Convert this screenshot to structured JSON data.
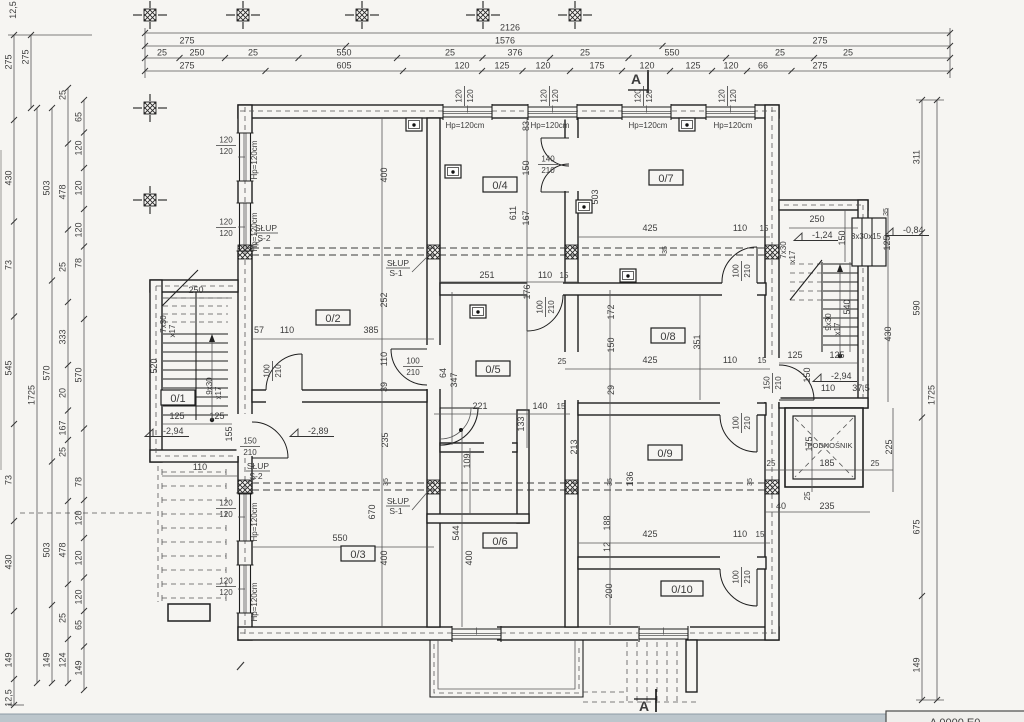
{
  "meta": {
    "paper_color": "#f6f5f2",
    "ink_color": "#1f1f1f",
    "dim_text_color": "#3c3c3c",
    "scanner_strip_color": "#bcc6cc"
  },
  "title_block": {
    "text": "A 0000 E0"
  },
  "section_markers": [
    [
      "A",
      636,
      84
    ],
    [
      "A",
      644,
      711
    ]
  ],
  "grid_crosses": [
    [
      150,
      15
    ],
    [
      243,
      15
    ],
    [
      362,
      15
    ],
    [
      483,
      15
    ],
    [
      575,
      15
    ],
    [
      150,
      108
    ],
    [
      150,
      200
    ]
  ],
  "fixtures": [
    [
      414,
      125
    ],
    [
      687,
      125
    ],
    [
      453,
      172
    ],
    [
      584,
      207
    ],
    [
      628,
      276
    ],
    [
      478,
      312
    ]
  ],
  "room_labels": [
    [
      "0/1",
      178,
      400
    ],
    [
      "0/2",
      333,
      320
    ],
    [
      "0/3",
      358,
      556
    ],
    [
      "0/4",
      500,
      187
    ],
    [
      "0/5",
      493,
      371
    ],
    [
      "0/6",
      500,
      543
    ],
    [
      "0/7",
      666,
      180
    ],
    [
      "0/8",
      668,
      338
    ],
    [
      "0/9",
      665,
      455
    ],
    [
      "0/10",
      682,
      591
    ]
  ],
  "dim_rows": [
    {
      "y": 33,
      "x1": 145,
      "x2": 950,
      "labels": [
        [
          "2126",
          510
        ]
      ]
    },
    {
      "y": 46,
      "x1": 145,
      "x2": 950,
      "labels": [
        [
          "275",
          187
        ],
        [
          "1576",
          505
        ],
        [
          "275",
          820
        ]
      ]
    },
    {
      "y": 58,
      "x1": 145,
      "x2": 950,
      "labels": [
        [
          "25",
          162
        ],
        [
          "250",
          197
        ],
        [
          "25",
          253
        ],
        [
          "550",
          344
        ],
        [
          "25",
          450
        ],
        [
          "376",
          515
        ],
        [
          "25",
          585
        ],
        [
          "550",
          672
        ],
        [
          "25",
          780
        ],
        [
          "25",
          848
        ]
      ]
    },
    {
      "y": 71,
      "x1": 145,
      "x2": 950,
      "labels": [
        [
          "275",
          187
        ],
        [
          "605",
          344
        ],
        [
          "120",
          462
        ],
        [
          "125",
          502
        ],
        [
          "120",
          543
        ],
        [
          "175",
          597
        ],
        [
          "120",
          647
        ],
        [
          "125",
          693
        ],
        [
          "120",
          731
        ],
        [
          "66",
          763
        ],
        [
          "275",
          820
        ]
      ]
    }
  ],
  "dim_cols": [
    {
      "x": 14,
      "y1": 35,
      "y2": 705,
      "labels": [
        [
          "275",
          62
        ],
        [
          "430",
          178
        ],
        [
          "73",
          265
        ],
        [
          "545",
          368
        ],
        [
          "73",
          480
        ],
        [
          "430",
          562
        ],
        [
          "149",
          660
        ],
        [
          "12,5",
          698
        ]
      ]
    },
    {
      "x": 31,
      "y1": 35,
      "y2": 108,
      "labels": [
        [
          "275",
          57
        ]
      ]
    },
    {
      "x": 37,
      "y1": 108,
      "y2": 683,
      "labels": [
        [
          "1725",
          395
        ]
      ]
    },
    {
      "x": 52,
      "y1": 108,
      "y2": 683,
      "labels": [
        [
          "503",
          188
        ],
        [
          "570",
          373
        ],
        [
          "503",
          550
        ],
        [
          "149",
          660
        ]
      ]
    },
    {
      "x": 68,
      "y1": 88,
      "y2": 683,
      "labels": [
        [
          "25",
          95
        ],
        [
          "478",
          192
        ],
        [
          "25",
          267
        ],
        [
          "333",
          337
        ],
        [
          "20",
          393
        ],
        [
          "167",
          428
        ],
        [
          "25",
          452
        ],
        [
          "478",
          550
        ],
        [
          "25",
          618
        ],
        [
          "124",
          660
        ]
      ]
    },
    {
      "x": 84,
      "y1": 100,
      "y2": 690,
      "labels": [
        [
          "65",
          117
        ],
        [
          "120",
          148
        ],
        [
          "120",
          188
        ],
        [
          "120",
          230
        ],
        [
          "78",
          263
        ],
        [
          "570",
          375
        ],
        [
          "78",
          482
        ],
        [
          "120",
          518
        ],
        [
          "120",
          558
        ],
        [
          "120",
          597
        ],
        [
          "65",
          625
        ],
        [
          "149",
          668
        ]
      ]
    },
    {
      "x": 922,
      "y1": 100,
      "y2": 700,
      "labels": [
        [
          "311",
          157
        ],
        [
          "590",
          308
        ],
        [
          "675",
          527
        ],
        [
          "149",
          665
        ]
      ]
    },
    {
      "x": 937,
      "y1": 100,
      "y2": 700,
      "labels": [
        [
          "1725",
          395
        ]
      ]
    }
  ],
  "texts": [
    [
      "400",
      387,
      175,
      -90,
      9
    ],
    [
      "252",
      387,
      300,
      -90,
      9
    ],
    [
      "110",
      387,
      359,
      -90,
      9
    ],
    [
      "39",
      387,
      387,
      -90,
      9
    ],
    [
      "235",
      388,
      440,
      -90,
      9
    ],
    [
      "57",
      259,
      333,
      0,
      9
    ],
    [
      "110",
      287,
      333,
      0,
      9
    ],
    [
      "385",
      371,
      333,
      0,
      9
    ],
    [
      "550",
      340,
      541,
      0,
      9
    ],
    [
      "670",
      375,
      512,
      -90,
      9
    ],
    [
      "400",
      387,
      558,
      -90,
      9
    ],
    [
      "251",
      487,
      278,
      0,
      9
    ],
    [
      "110",
      545,
      278,
      0,
      9
    ],
    [
      "15",
      564,
      278,
      0,
      8
    ],
    [
      "611",
      516,
      213,
      -90,
      9
    ],
    [
      "176",
      530,
      292,
      -90,
      9
    ],
    [
      "83",
      529,
      126,
      -90,
      9
    ],
    [
      "150",
      529,
      168,
      -90,
      9
    ],
    [
      "167",
      529,
      218,
      -90,
      9
    ],
    [
      "503",
      598,
      197,
      -90,
      9
    ],
    [
      "425",
      650,
      231,
      0,
      9
    ],
    [
      "110",
      740,
      231,
      0,
      9
    ],
    [
      "15",
      764,
      231,
      0,
      8
    ],
    [
      "25",
      562,
      364,
      0,
      8
    ],
    [
      "425",
      650,
      363,
      0,
      9
    ],
    [
      "110",
      730,
      363,
      0,
      9
    ],
    [
      "15",
      762,
      363,
      0,
      8
    ],
    [
      "172",
      614,
      312,
      -90,
      9
    ],
    [
      "351",
      700,
      342,
      -90,
      9
    ],
    [
      "150",
      614,
      345,
      -90,
      9
    ],
    [
      "29",
      614,
      390,
      -90,
      9
    ],
    [
      "221",
      480,
      409,
      0,
      9
    ],
    [
      "140",
      540,
      409,
      0,
      9
    ],
    [
      "15",
      561,
      409,
      0,
      8
    ],
    [
      "347",
      457,
      380,
      -90,
      9
    ],
    [
      "64",
      446,
      373,
      -90,
      9
    ],
    [
      "133",
      524,
      424,
      -90,
      9
    ],
    [
      "109",
      470,
      461,
      -90,
      9
    ],
    [
      "425",
      650,
      537,
      0,
      9
    ],
    [
      "110",
      740,
      537,
      0,
      9
    ],
    [
      "15",
      760,
      537,
      0,
      8
    ],
    [
      "213",
      577,
      447,
      -90,
      9
    ],
    [
      "136",
      633,
      479,
      -90,
      9
    ],
    [
      "188",
      610,
      523,
      -90,
      9
    ],
    [
      "12",
      610,
      547,
      -90,
      9
    ],
    [
      "200",
      612,
      591,
      -90,
      9
    ],
    [
      "544",
      459,
      533,
      -90,
      9
    ],
    [
      "400",
      472,
      558,
      -90,
      9
    ],
    [
      "35",
      388,
      482,
      -90,
      7
    ],
    [
      "35",
      612,
      482,
      -90,
      7
    ],
    [
      "35",
      752,
      482,
      -90,
      7
    ],
    [
      "35",
      667,
      250,
      -90,
      7
    ],
    [
      "110",
      200,
      470,
      0,
      9
    ],
    [
      "250",
      196,
      293,
      0,
      9
    ],
    [
      "520",
      157,
      366,
      -90,
      9
    ],
    [
      "125",
      177,
      419,
      0,
      9
    ],
    [
      "125",
      217,
      419,
      0,
      9
    ],
    [
      "155",
      232,
      434,
      -90,
      9
    ],
    [
      "7x30",
      166,
      324,
      -90,
      8
    ],
    [
      "x17",
      175,
      331,
      -90,
      8
    ],
    [
      "9x30",
      212,
      386,
      -90,
      8
    ],
    [
      "x17",
      221,
      393,
      -90,
      8
    ],
    [
      "250",
      817,
      222,
      0,
      9
    ],
    [
      "150",
      845,
      238,
      -90,
      9
    ],
    [
      "35",
      888,
      212,
      -90,
      7
    ],
    [
      "125",
      890,
      243,
      -90,
      9
    ],
    [
      "540",
      850,
      307,
      -90,
      9
    ],
    [
      "430",
      891,
      334,
      -90,
      9
    ],
    [
      "125",
      795,
      358,
      0,
      9
    ],
    [
      "125",
      837,
      358,
      0,
      9
    ],
    [
      "150",
      810,
      375,
      -90,
      9
    ],
    [
      "110",
      828,
      391,
      0,
      9
    ],
    [
      "37,5",
      861,
      391,
      0,
      9
    ],
    [
      "7x30",
      786,
      250,
      -90,
      8
    ],
    [
      "x17",
      795,
      257,
      -90,
      8
    ],
    [
      "9x30",
      831,
      322,
      -90,
      8
    ],
    [
      "x17",
      840,
      329,
      -90,
      8
    ],
    [
      "3x30x15",
      866,
      239,
      0,
      8
    ],
    [
      "PODNOŚNIK",
      830,
      448,
      0,
      7.5
    ],
    [
      "185",
      827,
      466,
      0,
      9
    ],
    [
      "25",
      771,
      466,
      0,
      8
    ],
    [
      "25",
      875,
      466,
      0,
      8
    ],
    [
      "175",
      812,
      444,
      -90,
      9
    ],
    [
      "225",
      892,
      447,
      -90,
      9
    ],
    [
      "25",
      810,
      496,
      -90,
      8
    ],
    [
      "40",
      781,
      509,
      0,
      9
    ],
    [
      "235",
      827,
      509,
      0,
      9
    ],
    [
      "12,5",
      16,
      10,
      -90,
      9
    ],
    [
      "Hp=120cm",
      465,
      128,
      0,
      8
    ],
    [
      "Hp=120cm",
      550,
      128,
      0,
      8
    ],
    [
      "Hp=120cm",
      648,
      128,
      0,
      8
    ],
    [
      "Hp=120cm",
      733,
      128,
      0,
      8
    ],
    [
      "Hp=120cm",
      257,
      160,
      -90,
      8
    ],
    [
      "Hp=120cm",
      257,
      232,
      -90,
      8
    ],
    [
      "Hp=120cm",
      257,
      522,
      -90,
      8
    ],
    [
      "Hp=120cm",
      257,
      602,
      -90,
      8
    ]
  ],
  "fractions": [
    [
      "120",
      "120",
      464,
      96,
      -90
    ],
    [
      "120",
      "120",
      549,
      96,
      -90
    ],
    [
      "120",
      "120",
      643,
      96,
      -90
    ],
    [
      "120",
      "120",
      727,
      96,
      -90
    ],
    [
      "120",
      "120",
      226,
      145,
      0
    ],
    [
      "120",
      "120",
      226,
      227,
      0
    ],
    [
      "120",
      "120",
      226,
      508,
      0
    ],
    [
      "120",
      "120",
      226,
      586,
      0
    ],
    [
      "100",
      "210",
      272,
      371,
      -90
    ],
    [
      "100",
      "210",
      413,
      366,
      0
    ],
    [
      "140",
      "210",
      548,
      164,
      0
    ],
    [
      "100",
      "210",
      545,
      307,
      -90
    ],
    [
      "100",
      "210",
      741,
      271,
      -90
    ],
    [
      "100",
      "210",
      741,
      423,
      -90
    ],
    [
      "100",
      "210",
      741,
      577,
      -90
    ],
    [
      "150",
      "210",
      250,
      446,
      0
    ],
    [
      "150",
      "210",
      772,
      383,
      -90
    ]
  ],
  "levels": [
    [
      "-2,94",
      163,
      434
    ],
    [
      "-2,89",
      308,
      434
    ],
    [
      "-1,24",
      812,
      238
    ],
    [
      "-0,84",
      903,
      233
    ],
    [
      "-2,94",
      831,
      379
    ]
  ],
  "slup_labels": [
    [
      "SŁUP",
      "S-2",
      266,
      231
    ],
    [
      "SŁUP",
      "S-1",
      398,
      266
    ],
    [
      "SŁUP",
      "S-2",
      258,
      469
    ],
    [
      "SŁUP",
      "S-1",
      398,
      504
    ]
  ]
}
